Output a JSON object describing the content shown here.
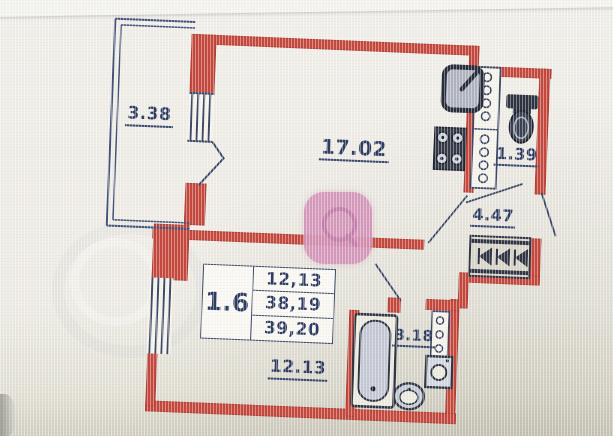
{
  "floorplan": {
    "rooms": {
      "balcony": "3.38",
      "living_room": "17.02",
      "toilet": "1.39",
      "hallway": "4.47",
      "bathroom": "3.18",
      "bedroom": "12.13"
    },
    "stamp": {
      "plan_code": "1.6",
      "living_area": "12,13",
      "apartment_area": "38,19",
      "total_area": "39,20"
    }
  },
  "colors": {
    "wall_red": "#c5483d",
    "ink_blue": "#36436a",
    "paper": "#edeae2",
    "watermark_pink": "#d392b8"
  }
}
